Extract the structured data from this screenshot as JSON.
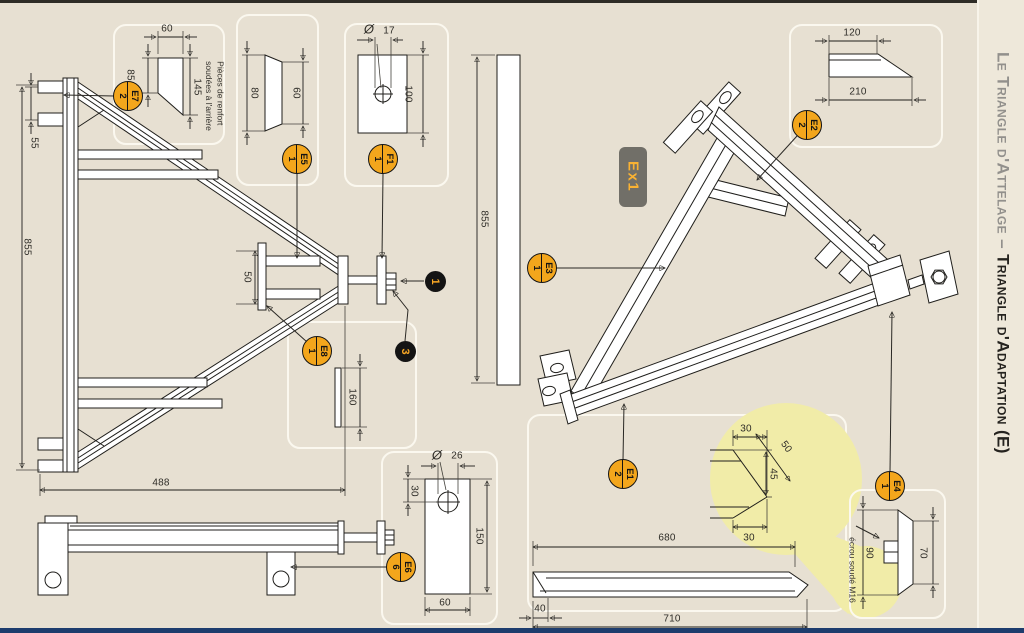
{
  "sidebar": {
    "title_gray": "Le Triangle d'Attelage – ",
    "title_black": "Triangle d'Adaptation (E)"
  },
  "badge": {
    "label": "Ex1"
  },
  "notes": {
    "reinforcement": [
      "Pièces de renfort",
      "soudées à l'arrière"
    ],
    "welded_nut": "écrou soudé M16"
  },
  "callouts": {
    "e7": {
      "ref": "E7",
      "qty": "2"
    },
    "e5": {
      "ref": "E5",
      "qty": "1"
    },
    "f1": {
      "ref": "F1",
      "qty": "1"
    },
    "e2": {
      "ref": "E2",
      "qty": "2"
    },
    "e3": {
      "ref": "E3",
      "qty": "1"
    },
    "e8": {
      "ref": "E8",
      "qty": "1"
    },
    "e1": {
      "ref": "E1",
      "qty": "2"
    },
    "e4": {
      "ref": "E4",
      "qty": "1"
    },
    "e6": {
      "ref": "E6",
      "qty": "6"
    }
  },
  "markers": {
    "m1": "1",
    "m3": "3"
  },
  "dims": {
    "e7_width": "60",
    "e7_left": "85",
    "e7_right": "145",
    "frame_tab": "55",
    "frame_height": "855",
    "frame_base": "488",
    "apex_gap": "50",
    "e5_left": "80",
    "e5_right": "60",
    "f1_dia_sym": "Ø",
    "f1_dia": "17",
    "f1_height": "100",
    "e2_top": "120",
    "e2_base": "210",
    "beam_length": "855",
    "e8_length": "160",
    "e6_dia_sym": "Ø",
    "e6_dia": "26",
    "e6_hole_offset": "30",
    "e6_height": "150",
    "e6_width": "60",
    "bar_680": "680",
    "bar_710": "710",
    "bar_40": "40",
    "tip_top": "30",
    "tip_diag": "50",
    "tip_vert": "45",
    "tip_bottom": "30",
    "e4_height": "90",
    "e4_width": "70"
  },
  "colors": {
    "page_bg": "#e7e0d2",
    "accent_orange": "#f3a61c",
    "highlight_yellow": "#f1eca8",
    "footer_navy": "#1d3c6d"
  }
}
